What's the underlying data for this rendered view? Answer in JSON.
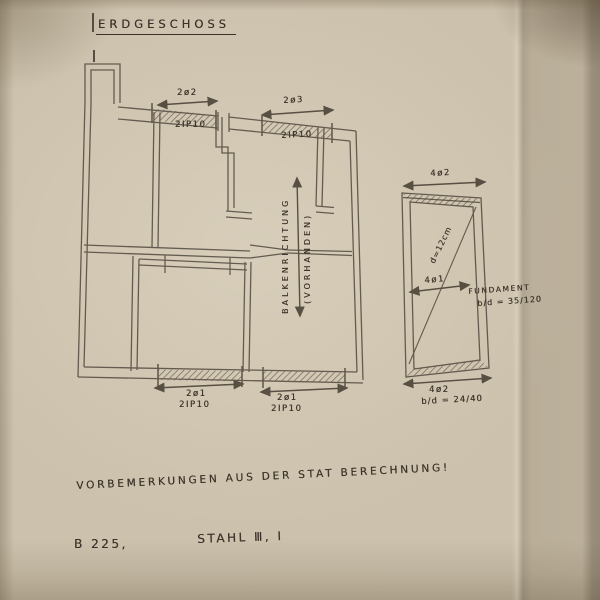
{
  "colors": {
    "paper": "#ccc1ac",
    "ink": "#3a3128",
    "plan_line": "#4c443a"
  },
  "title": "ERDGESCHOSS",
  "plan": {
    "beams": {
      "top_left": {
        "bars": "2ø2",
        "profile": "2IP10"
      },
      "top_right": {
        "bars": "2ø3",
        "profile": "2IP10"
      },
      "bottom_left": {
        "bars": "2ø1",
        "profile": "2IP10"
      },
      "bottom_mid": {
        "bars": "2ø1",
        "profile": "2IP10"
      }
    },
    "beam_direction_label": "BALKENRICHTUNG",
    "beam_direction_note": "(VORHANDEN)"
  },
  "foundation": {
    "top_bars": "4ø2",
    "diagonal_dim": "d=12cm",
    "mid_bars": "4ø1",
    "bottom_bars": "4ø2",
    "bottom_dim": "b/d = 24/40",
    "label": "FUNDAMENT",
    "label_dim": "b/d = 35/120"
  },
  "notes": {
    "remark": "VORBEMERKUNGEN AUS DER STAT BERECHNUNG!",
    "concrete": "B 225,",
    "steel": "STAHL Ⅲ, Ⅰ"
  }
}
